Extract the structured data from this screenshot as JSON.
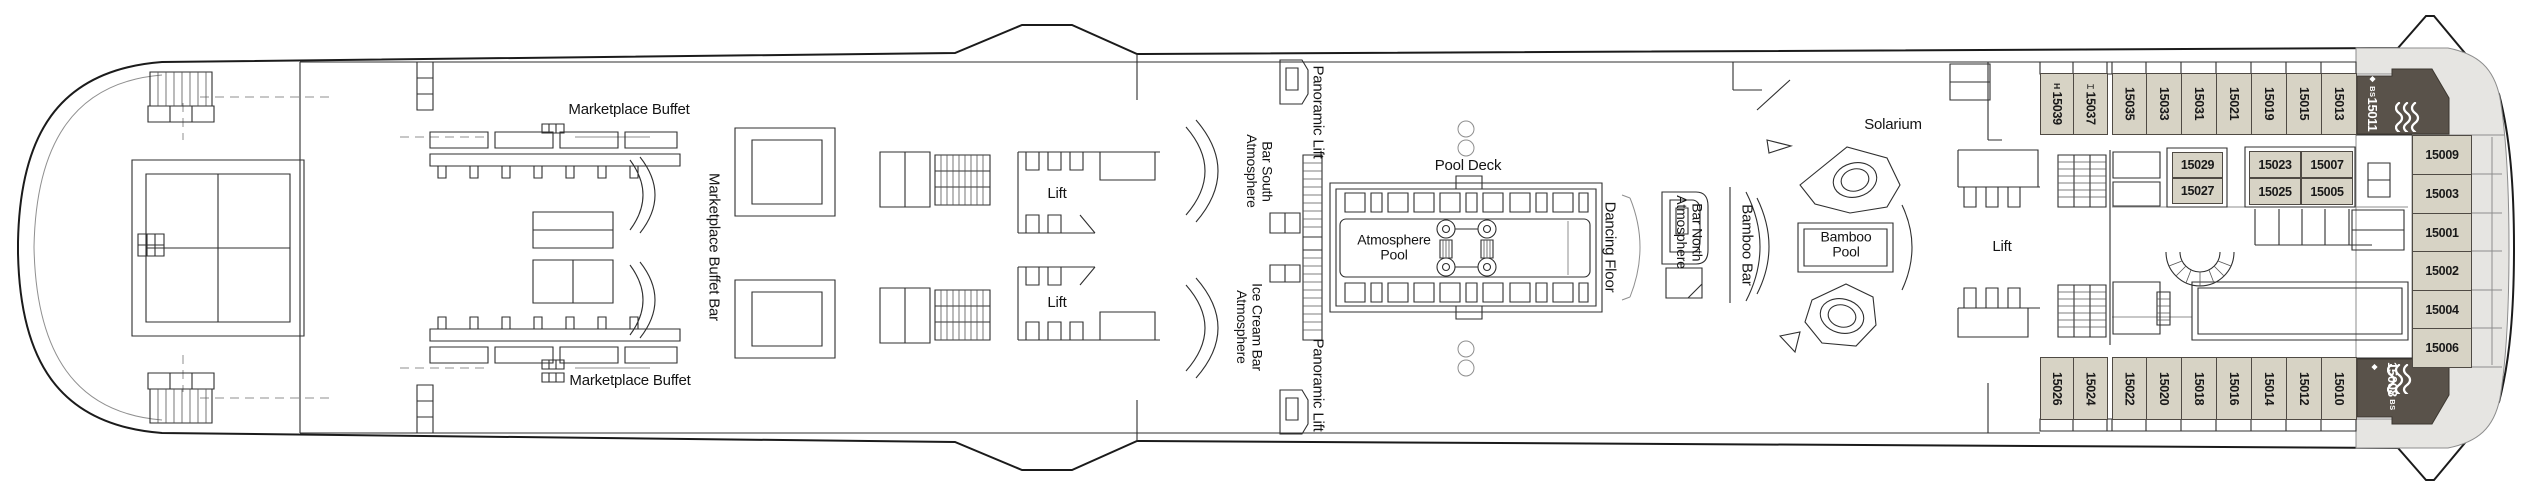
{
  "deck": {
    "venues": {
      "marketplace_buffet_upper": "Marketplace Buffet",
      "marketplace_buffet_lower": "Marketplace Buffet",
      "marketplace_buffet_bar": "Marketplace Buffet Bar",
      "lift_forward_upper": "Lift",
      "lift_forward_lower": "Lift",
      "panoramic_lift_upper": "Panoramic Lift",
      "panoramic_lift_lower": "Panoramic Lift",
      "atmosphere_bar_south": {
        "line1": "Atmosphere",
        "line2": "Bar South"
      },
      "atmosphere_ice_cream_bar": {
        "line1": "Atmosphere",
        "line2": "Ice Cream Bar"
      },
      "pool_deck": "Pool Deck",
      "atmosphere_pool": {
        "line1": "Atmosphere",
        "line2": "Pool"
      },
      "dancing_floor": "Dancing Floor",
      "atmosphere_bar_north": {
        "line1": "Atmosphere",
        "line2": "Bar North"
      },
      "bamboo_bar": "Bamboo Bar",
      "bamboo_pool": {
        "line1": "Bamboo",
        "line2": "Pool"
      },
      "solarium": "Solarium",
      "lift_aft": "Lift"
    },
    "cabins": {
      "top_row": [
        "15039",
        "15037",
        "15035",
        "15033",
        "15031",
        "15021",
        "15019",
        "15015",
        "15013"
      ],
      "bottom_row": [
        "15026",
        "15024",
        "15022",
        "15020",
        "15018",
        "15016",
        "15014",
        "15012",
        "15010"
      ],
      "aft_column": [
        "15009",
        "15003",
        "15001",
        "15002",
        "15004",
        "15006"
      ],
      "mid_block_forward": [
        "15029",
        "15027"
      ],
      "mid_block_aft": [
        [
          "15023",
          "15007"
        ],
        [
          "15025",
          "15005"
        ]
      ],
      "symbols": {
        "15039": "H",
        "15037": "⌶"
      },
      "suites": [
        {
          "number": "15011",
          "category": "BS",
          "marker": "◆"
        },
        {
          "number": "15008",
          "category": "BS",
          "marker": "◆"
        }
      ]
    },
    "colors": {
      "cabin_fill": "#d7d3c5",
      "suite_fill": "#59524a",
      "terrace_fill": "#e6e5e2",
      "line": "#2f2f2f"
    }
  }
}
